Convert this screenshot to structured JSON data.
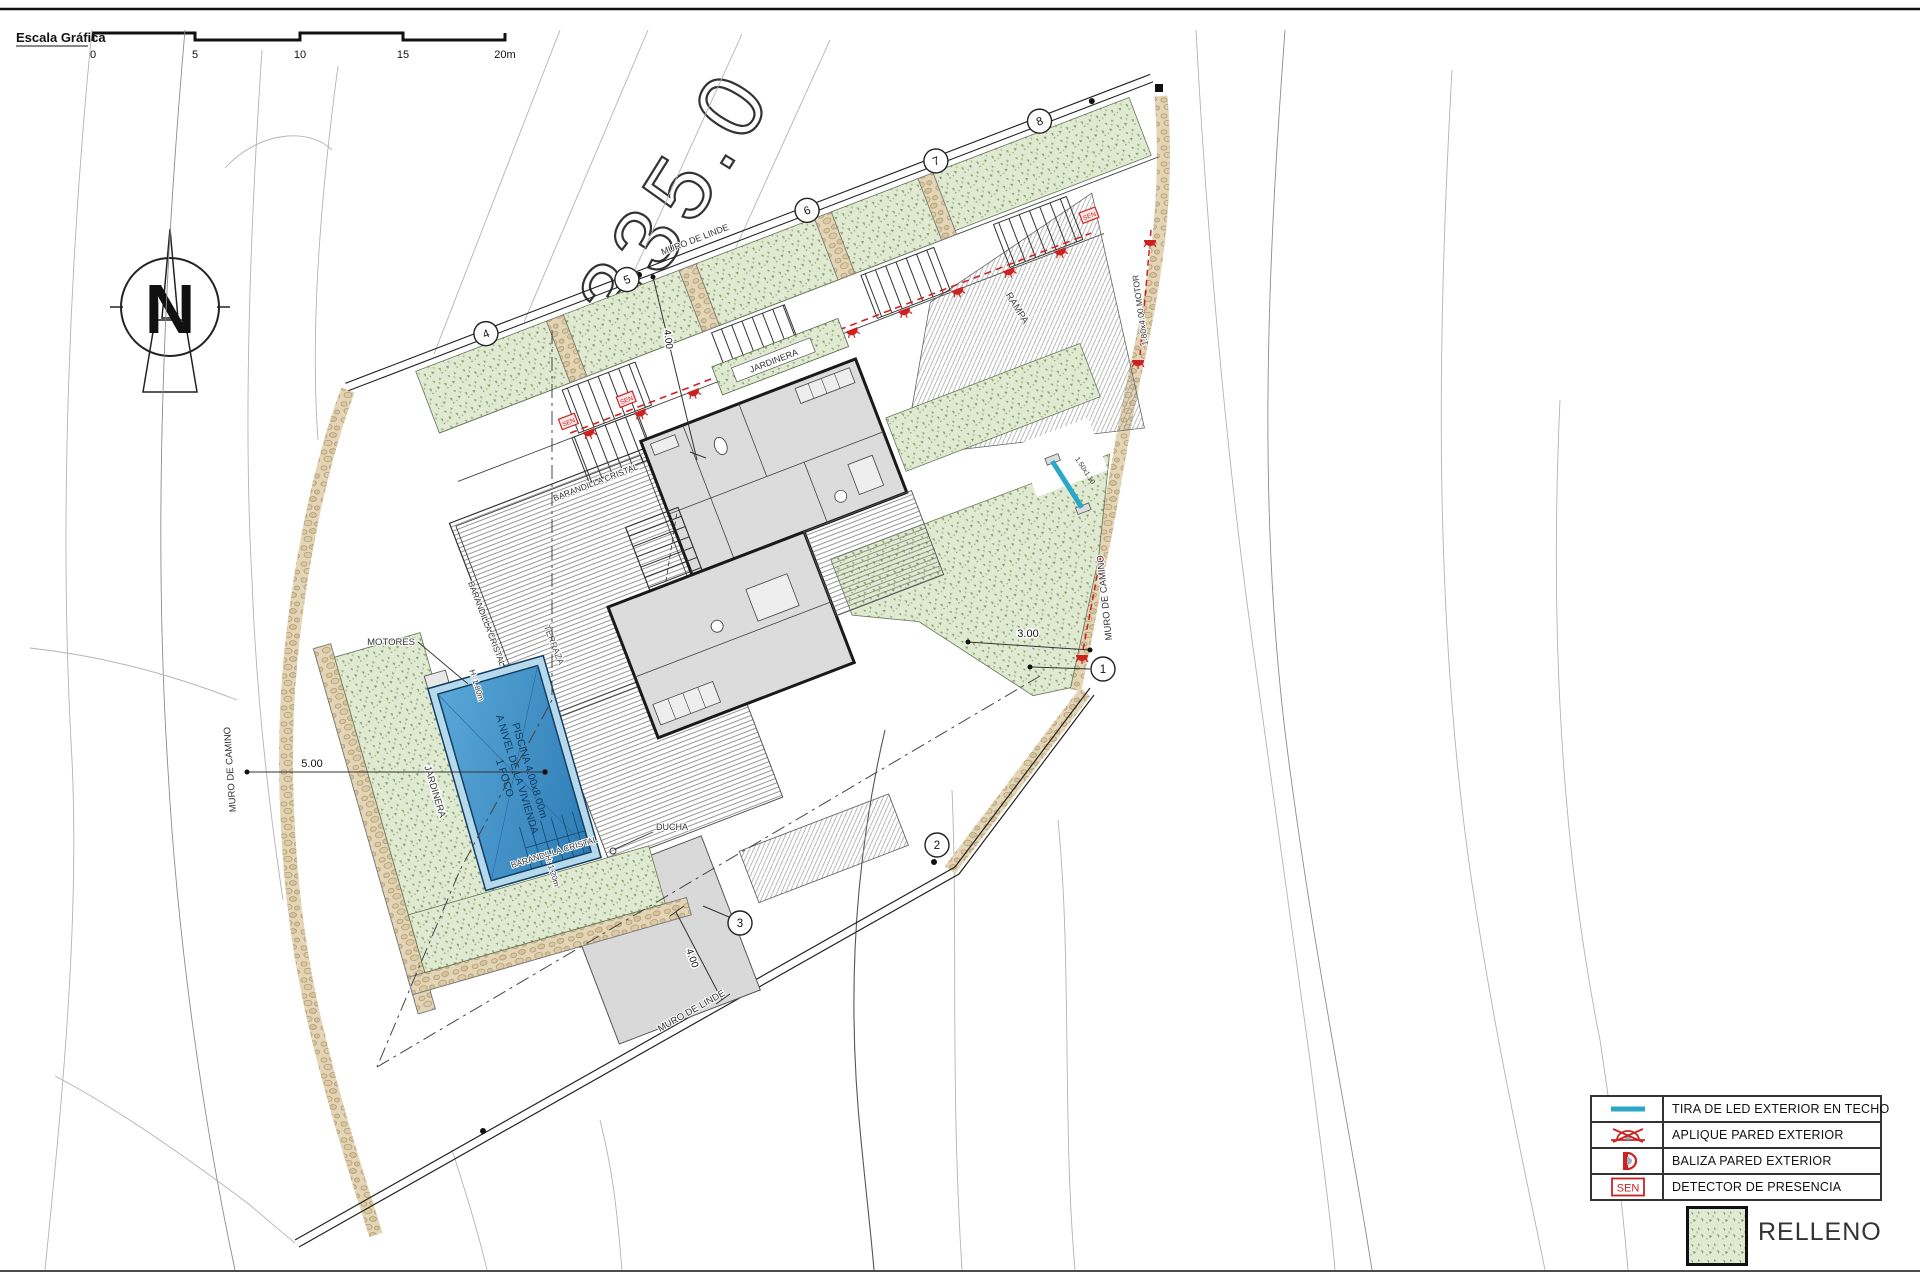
{
  "scale_bar": {
    "title": "Escala Gráfica",
    "ticks": [
      "0",
      "5",
      "10",
      "15",
      "20m"
    ]
  },
  "north_label": "N",
  "big_contour_label": "335.0",
  "plan": {
    "muro_linde_top": "MURO DE LINDE",
    "muro_linde_bottom": "MURO DE LINDE",
    "muro_camino_left": "MURO DE CAMINO",
    "muro_camino_right": "MURO DE CAMINO",
    "rampa": "RAMPA",
    "motor_gate": "1.80x4.00 MOTOR",
    "gate_size": "1.50x1.10",
    "jardinera_top": "JARDINERA",
    "jardinera_pool": "JARDINERA",
    "motores": "MOTORES",
    "ducha": "DUCHA",
    "terraza": "TERRAZA",
    "barandilla_top": "BARANDILLA CRISTAL",
    "barandilla_left": "BARANDILLA CRISTAL",
    "barandilla_pool": "BARANDILLA CRISTAL",
    "sen": "SEN",
    "pool": {
      "line1": "PISCINA 4.00x8.00m",
      "line2": "A NIVEL DE LA VIVIENDA",
      "line3": "1 FOCO",
      "h_top": "H: 1.80m",
      "h_bottom": "H: 1.20m"
    },
    "dims": {
      "left": "5.00",
      "right": "3.00",
      "top": "4.00",
      "bottom": "4.00"
    },
    "markers": [
      "1",
      "2",
      "3",
      "4",
      "5",
      "6",
      "7",
      "8"
    ]
  },
  "legend": {
    "rows": [
      {
        "label": "TIRA DE LED EXTERIOR EN TECHO"
      },
      {
        "label": "APLIQUE PARED EXTERIOR"
      },
      {
        "label": "BALIZA PARED EXTERIOR"
      },
      {
        "label": "DETECTOR DE PRESENCIA"
      }
    ],
    "sen_symbol_text": "SEN",
    "relleno_label": "RELLENO"
  },
  "colors": {
    "relleno_green": "#e0ead2",
    "speckle_green": "#7f9c62",
    "stone_tan": "#e3d5b6",
    "pool_blue": "#3f8fc4",
    "led_cyan": "#2aa7c9",
    "light_red": "#cc2222"
  }
}
